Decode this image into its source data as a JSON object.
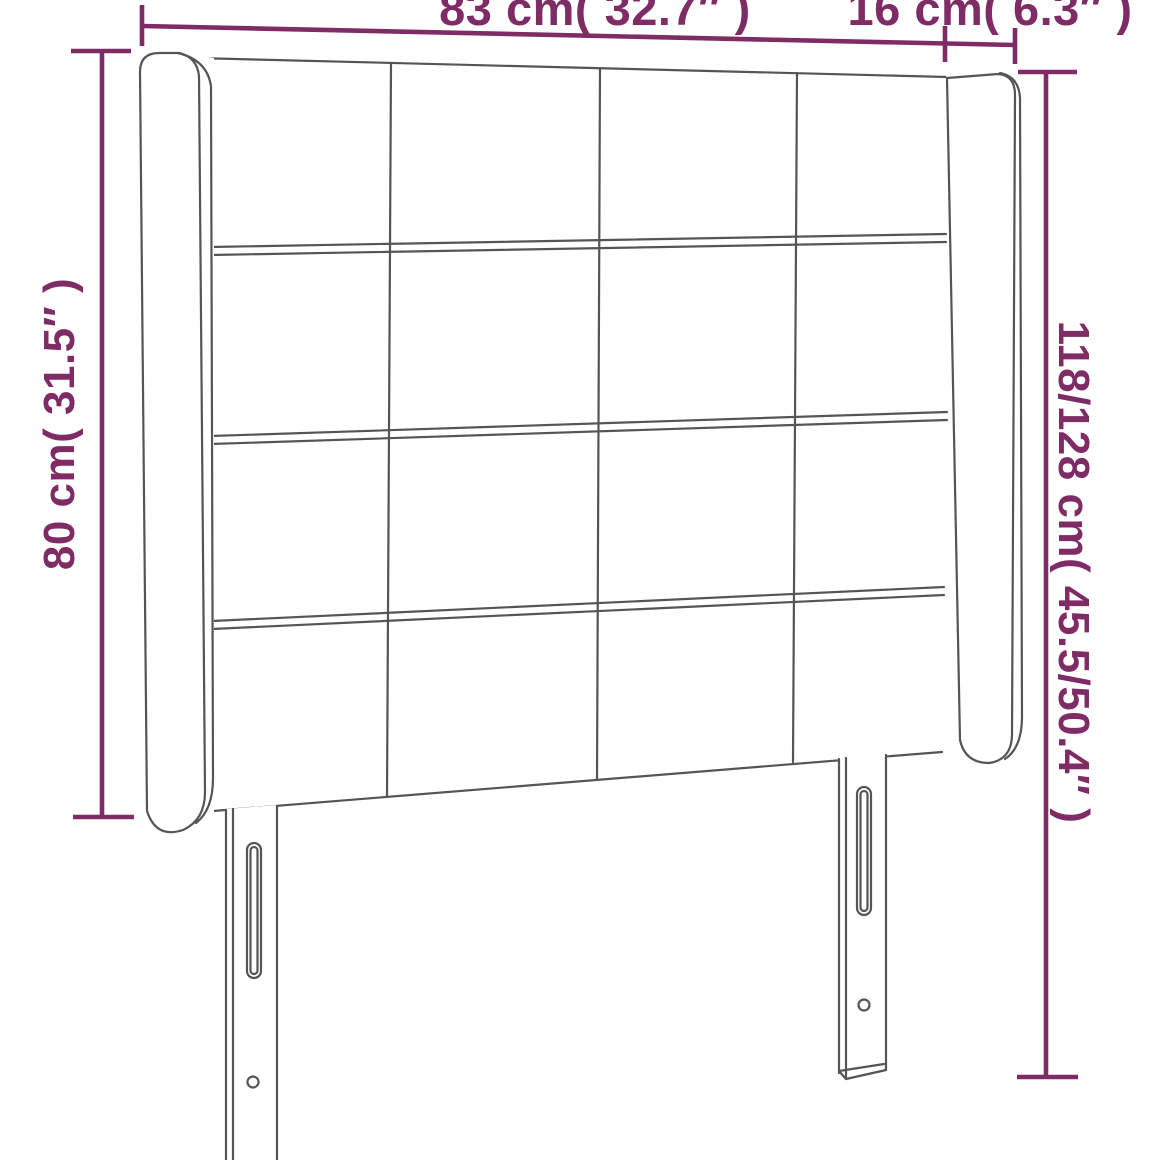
{
  "diagram": {
    "title": "headboard-dimension-diagram",
    "product": "upholstered headboard with wings and two slotted legs, 4x4 tufted grid",
    "background_color": "#ffffff",
    "drawing_line_color": "#555555",
    "dimension_color": "#7e2b66",
    "dimensions": {
      "top_width": "83 cm( 32.7″ )",
      "wing_depth": "16 cm( 6.3″ )",
      "front_height": "80 cm( 31.5″ )",
      "total_height": "118/128 cm( 45.5/50.4″ )"
    }
  }
}
